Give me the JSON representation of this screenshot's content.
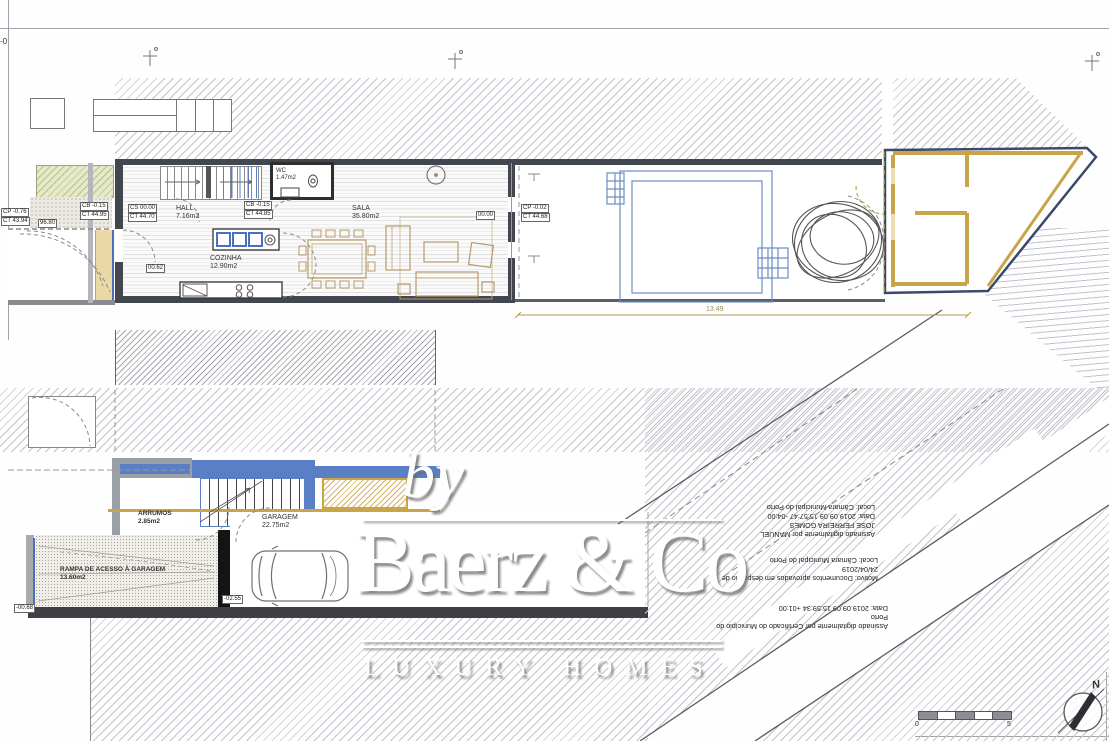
{
  "frame": {
    "corner_mark": "-0"
  },
  "upper_plan": {
    "labels": {
      "cp_left_top": "CP -0.76",
      "cp_left_bot": "CT 43.94",
      "small_dim": "96.80",
      "cb_left_top": "CB -0.15",
      "cb_left_bot": "CT 44.95",
      "cs_top": "CS 00.00",
      "cs_bot": "CT 44.70",
      "cb_mid_top": "CB -0.15",
      "cb_mid_bot": "CT 44.85",
      "door_level": "00.62",
      "sala_level": "00.00",
      "terrace_top": "CP -0.02",
      "terrace_bot": "CT 44.68",
      "terrace_dim": "13.49"
    },
    "rooms": {
      "hall": {
        "name": "HALL",
        "area": "7.16m2"
      },
      "wc": {
        "name": "WC",
        "area": "1.47m2"
      },
      "cozinha": {
        "name": "COZINHA",
        "area": "12.90m2"
      },
      "sala": {
        "name": "SALA",
        "area": "35.80m2"
      }
    }
  },
  "lower_plan": {
    "rooms": {
      "arrumos": {
        "name": "ARRUMOS",
        "area": "2.85m2"
      },
      "garagem": {
        "name": "GARAGEM",
        "area": "22.75m2"
      },
      "rampa": {
        "name": "RAMPA DE ACESSO À GARAGEM",
        "area": "13.60m2"
      }
    },
    "labels": {
      "garage_level": "-02.55",
      "ramp_level": "-00.68"
    }
  },
  "signatures": {
    "sig1_line1": "Assinado digitalmente por MANUEL",
    "sig1_line2": "JOSE FERREIRA GOMES",
    "sig1_line3": "Data: 2019.09.09 15:57:47 -04:00",
    "sig1_line4": "Local: Câmara Municipal do Porto",
    "sig2_line1": "Motivo: Documentos aprovados em despacho de",
    "sig2_line2": "24/04/2019",
    "sig2_line3": "Local: Câmara Municipal do Porto",
    "sig3_line1": "Assinado digitalmente por Certificado do Município do",
    "sig3_line2": "Porto",
    "sig3_line3": "Data: 2019.09.09 15:59:34 +01:00"
  },
  "watermark": {
    "by": "by",
    "brand": "Baerz & Co",
    "tagline": "LUXURY HOMES"
  },
  "scale_bar": {
    "start": "0",
    "end": "5"
  },
  "compass": {
    "north": "N"
  },
  "colors": {
    "navy": "#3b4a6b",
    "gold": "#c9a449",
    "blue": "#5b7fc4",
    "wall": "#42464e",
    "green": "#e4e9ca"
  }
}
